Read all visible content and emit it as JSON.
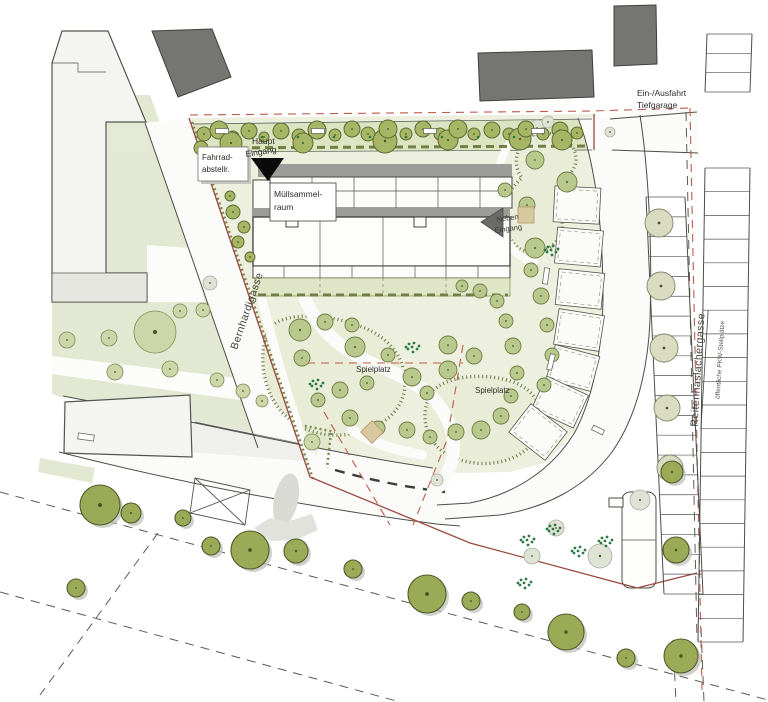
{
  "labels": {
    "garage_access_l1": "Ein-/Ausfahrt",
    "garage_access_l2": "Tiefgarage",
    "bike_l1": "Fahrrad-",
    "bike_l2": "abstellr.",
    "main_entrance_l1": "Haupt",
    "main_entrance_l2": "Eingang",
    "waste_l1": "Müllsammel-",
    "waste_l2": "raum",
    "side_entrance_l1": "Neben",
    "side_entrance_l2": "Eingang",
    "playground_left": "Spielplatz",
    "playground_right": "Spielplatz",
    "street_west": "Bernhardigasse",
    "street_east": "Reitenhaslachergasse",
    "public_parking": "öffentliche PKW-Stellplätze"
  },
  "colors": {
    "boundary_red": "#9a4a3c",
    "dashed_red": "#c05a4a",
    "tree_olive": "#a7b665",
    "tree_dark": "#9aaa57",
    "building_dark": "#757571",
    "building_light": "#f4f4f1",
    "lawn_green": "#e3e8d2",
    "site_green": "#edf0df",
    "tree_band_green": "#dce4c2",
    "sand": "#d8c8a0"
  },
  "tree_groups": [
    {
      "gid": "trees-top",
      "cls": "t-olive",
      "items": [
        [
          204,
          134,
          7
        ],
        [
          219,
          130,
          9
        ],
        [
          233,
          137,
          6
        ],
        [
          231,
          143,
          11
        ],
        [
          249,
          131,
          8
        ],
        [
          264,
          137,
          5
        ],
        [
          281,
          131,
          8
        ],
        [
          299,
          136,
          7
        ],
        [
          303,
          143,
          10
        ],
        [
          317,
          130,
          9
        ],
        [
          335,
          135,
          6
        ],
        [
          352,
          129,
          8
        ],
        [
          368,
          134,
          7
        ],
        [
          385,
          141,
          12
        ],
        [
          388,
          129,
          9
        ],
        [
          406,
          134,
          6
        ],
        [
          423,
          129,
          8
        ],
        [
          440,
          134,
          6
        ],
        [
          448,
          140,
          10
        ],
        [
          458,
          129,
          9
        ],
        [
          474,
          134,
          6
        ],
        [
          492,
          130,
          8
        ],
        [
          509,
          134,
          6
        ],
        [
          520,
          139,
          11
        ],
        [
          526,
          129,
          8
        ],
        [
          543,
          134,
          6
        ],
        [
          560,
          130,
          8
        ],
        [
          562,
          140,
          10
        ],
        [
          577,
          133,
          6
        ],
        [
          201,
          148,
          7
        ]
      ]
    },
    {
      "gid": "trees-near-road",
      "cls": "t-olive",
      "items": [
        [
          233,
          212,
          7
        ],
        [
          244,
          227,
          6
        ],
        [
          238,
          242,
          6
        ],
        [
          250,
          257,
          5
        ],
        [
          230,
          196,
          5
        ]
      ]
    },
    {
      "gid": "trees-meadow",
      "cls": "t-pale",
      "items": [
        [
          67,
          340,
          8
        ],
        [
          109,
          338,
          8
        ],
        [
          155,
          332,
          21
        ],
        [
          180,
          311,
          7
        ],
        [
          203,
          310,
          7
        ],
        [
          115,
          372,
          8
        ],
        [
          170,
          369,
          8
        ],
        [
          217,
          380,
          7
        ],
        [
          243,
          391,
          7
        ],
        [
          262,
          401,
          6
        ],
        [
          312,
          442,
          8
        ]
      ]
    },
    {
      "gid": "trees-court",
      "cls": "t-pale2",
      "items": [
        [
          355,
          347,
          10
        ],
        [
          388,
          355,
          7
        ],
        [
          412,
          377,
          9
        ],
        [
          427,
          393,
          7
        ],
        [
          448,
          345,
          9
        ],
        [
          474,
          356,
          8
        ],
        [
          448,
          370,
          9
        ],
        [
          340,
          390,
          8
        ],
        [
          367,
          383,
          7
        ],
        [
          300,
          330,
          11
        ],
        [
          325,
          322,
          8
        ],
        [
          352,
          325,
          7
        ],
        [
          302,
          358,
          8
        ],
        [
          318,
          400,
          7
        ],
        [
          350,
          418,
          8
        ],
        [
          378,
          428,
          7
        ],
        [
          407,
          430,
          8
        ],
        [
          430,
          437,
          7
        ],
        [
          456,
          432,
          8
        ],
        [
          481,
          430,
          9
        ],
        [
          501,
          416,
          8
        ],
        [
          511,
          396,
          7
        ],
        [
          517,
          373,
          7
        ],
        [
          513,
          346,
          8
        ],
        [
          506,
          321,
          7
        ],
        [
          497,
          301,
          7
        ],
        [
          480,
          291,
          7
        ],
        [
          462,
          286,
          6
        ],
        [
          531,
          270,
          7
        ],
        [
          541,
          296,
          8
        ],
        [
          535,
          248,
          10
        ],
        [
          527,
          205,
          8
        ],
        [
          535,
          160,
          9
        ],
        [
          567,
          182,
          10
        ],
        [
          505,
          190,
          7
        ],
        [
          547,
          325,
          7
        ],
        [
          552,
          355,
          7
        ],
        [
          544,
          385,
          7
        ]
      ]
    },
    {
      "gid": "trees-ladder",
      "cls": "t-khaki",
      "items": [
        [
          659,
          223,
          14
        ],
        [
          661,
          286,
          14
        ],
        [
          664,
          348,
          14
        ],
        [
          667,
          408,
          13
        ],
        [
          670,
          468,
          13
        ]
      ]
    },
    {
      "gid": "trees-bottom",
      "cls": "t-dark",
      "shadow": true,
      "items": [
        [
          100,
          505,
          20
        ],
        [
          131,
          513,
          10
        ],
        [
          183,
          518,
          8
        ],
        [
          211,
          546,
          9
        ],
        [
          250,
          550,
          19
        ],
        [
          296,
          551,
          12
        ],
        [
          353,
          569,
          9
        ],
        [
          76,
          588,
          9
        ],
        [
          427,
          594,
          19
        ],
        [
          471,
          601,
          9
        ],
        [
          522,
          612,
          8
        ],
        [
          566,
          632,
          18
        ],
        [
          626,
          658,
          9
        ],
        [
          681,
          656,
          17
        ],
        [
          672,
          472,
          11
        ],
        [
          676,
          550,
          13
        ]
      ]
    },
    {
      "gid": "trees-ghost",
      "cls": "t-ghost",
      "items": [
        [
          210,
          283,
          7
        ],
        [
          537,
          128,
          8
        ],
        [
          548,
          122,
          6
        ],
        [
          524,
          131,
          5
        ],
        [
          600,
          556,
          12
        ],
        [
          640,
          500,
          10
        ],
        [
          610,
          132,
          5
        ],
        [
          437,
          480,
          6
        ],
        [
          556,
          528,
          8
        ],
        [
          532,
          556,
          8
        ]
      ]
    }
  ],
  "parking_ladders": [
    {
      "gid": "ladder-outer-a",
      "l": [
        707,
        34,
        705,
        92
      ],
      "r": [
        752,
        34,
        750,
        92
      ],
      "stalls": 3
    },
    {
      "gid": "ladder-outer-b",
      "l": [
        705,
        168,
        698,
        642
      ],
      "r": [
        750,
        168,
        743,
        642
      ],
      "stalls": 20
    },
    {
      "gid": "ladder-inner",
      "l": [
        646,
        197,
        664,
        594
      ],
      "r": [
        685,
        197,
        703,
        594
      ],
      "stalls": 20
    }
  ],
  "garden_plots": {
    "w": 46,
    "h": 36,
    "items": [
      [
        577,
        205,
        3
      ],
      [
        579,
        247,
        5
      ],
      [
        580,
        289,
        6
      ],
      [
        579,
        330,
        9
      ],
      [
        573,
        368,
        15
      ],
      [
        560,
        402,
        25
      ],
      [
        538,
        432,
        38
      ]
    ]
  },
  "benches": [
    [
      222,
      131,
      13,
      5,
      0
    ],
    [
      318,
      131,
      13,
      5,
      0
    ],
    [
      430,
      131,
      13,
      5,
      0
    ],
    [
      538,
      131,
      13,
      5,
      0
    ],
    [
      86,
      437,
      16,
      6,
      8
    ],
    [
      546,
      276,
      5,
      16,
      8
    ],
    [
      551,
      362,
      5,
      16,
      14
    ],
    [
      598,
      430,
      12,
      5,
      25
    ]
  ],
  "shrub_clusters": [
    [
      527,
      540
    ],
    [
      553,
      529
    ],
    [
      578,
      551
    ],
    [
      605,
      541
    ],
    [
      524,
      583
    ],
    [
      316,
      384
    ],
    [
      412,
      347
    ],
    [
      551,
      250
    ]
  ],
  "band_dots": {
    "y": 137,
    "xs": [
      262,
      298,
      334,
      370,
      406,
      442,
      478,
      514
    ]
  }
}
